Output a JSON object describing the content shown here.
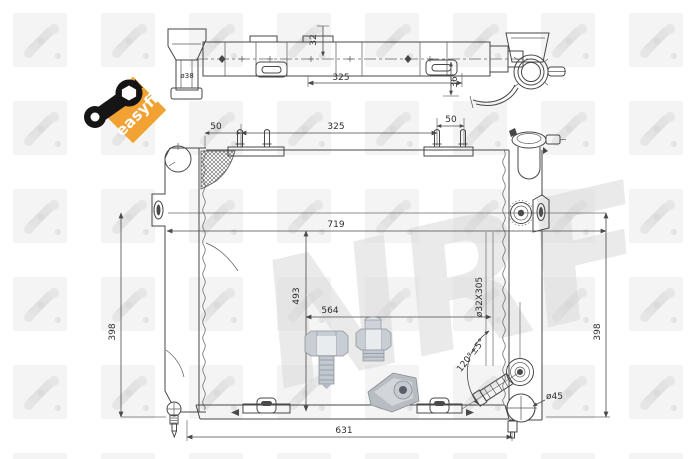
{
  "brand": "NRF",
  "watermark": {
    "text": "NRF"
  },
  "badge": {
    "label": "easyfit"
  },
  "top_view": {
    "dims": {
      "pipe_diameter": "ø38",
      "tank_offset": "32",
      "mount_span": "325",
      "bracket_depth": "36"
    }
  },
  "front_view": {
    "dims": {
      "pin_offset_left": "50",
      "pin_span": "325",
      "pin_offset_right": "50",
      "overall_width": "719",
      "core_height": "493",
      "lower_span": "564",
      "height_left": "398",
      "height_right": "398",
      "oil_cooler": "ø32X305",
      "outlet_angle": "120°±5°",
      "outlet_diameter": "ø45",
      "bottom_span": "631"
    }
  }
}
